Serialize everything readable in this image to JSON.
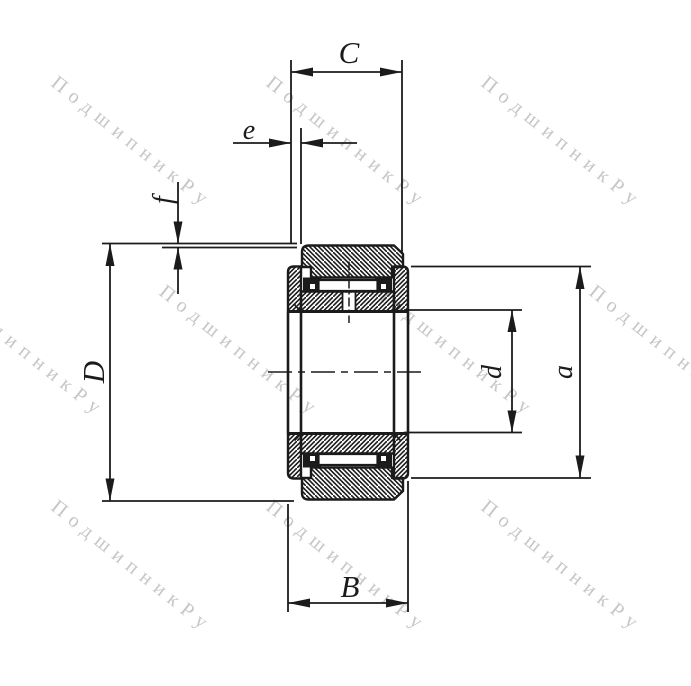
{
  "drawing": {
    "type": "bearing-cross-section",
    "labels": {
      "C": "C",
      "e": "e",
      "f": "f",
      "D": "D",
      "d": "d",
      "a": "a",
      "B": "B"
    },
    "watermark": {
      "text": "ПодшипникРу",
      "color": "#c6c6c6"
    },
    "line_color": "#1b1b1b",
    "background": "#ffffff"
  }
}
